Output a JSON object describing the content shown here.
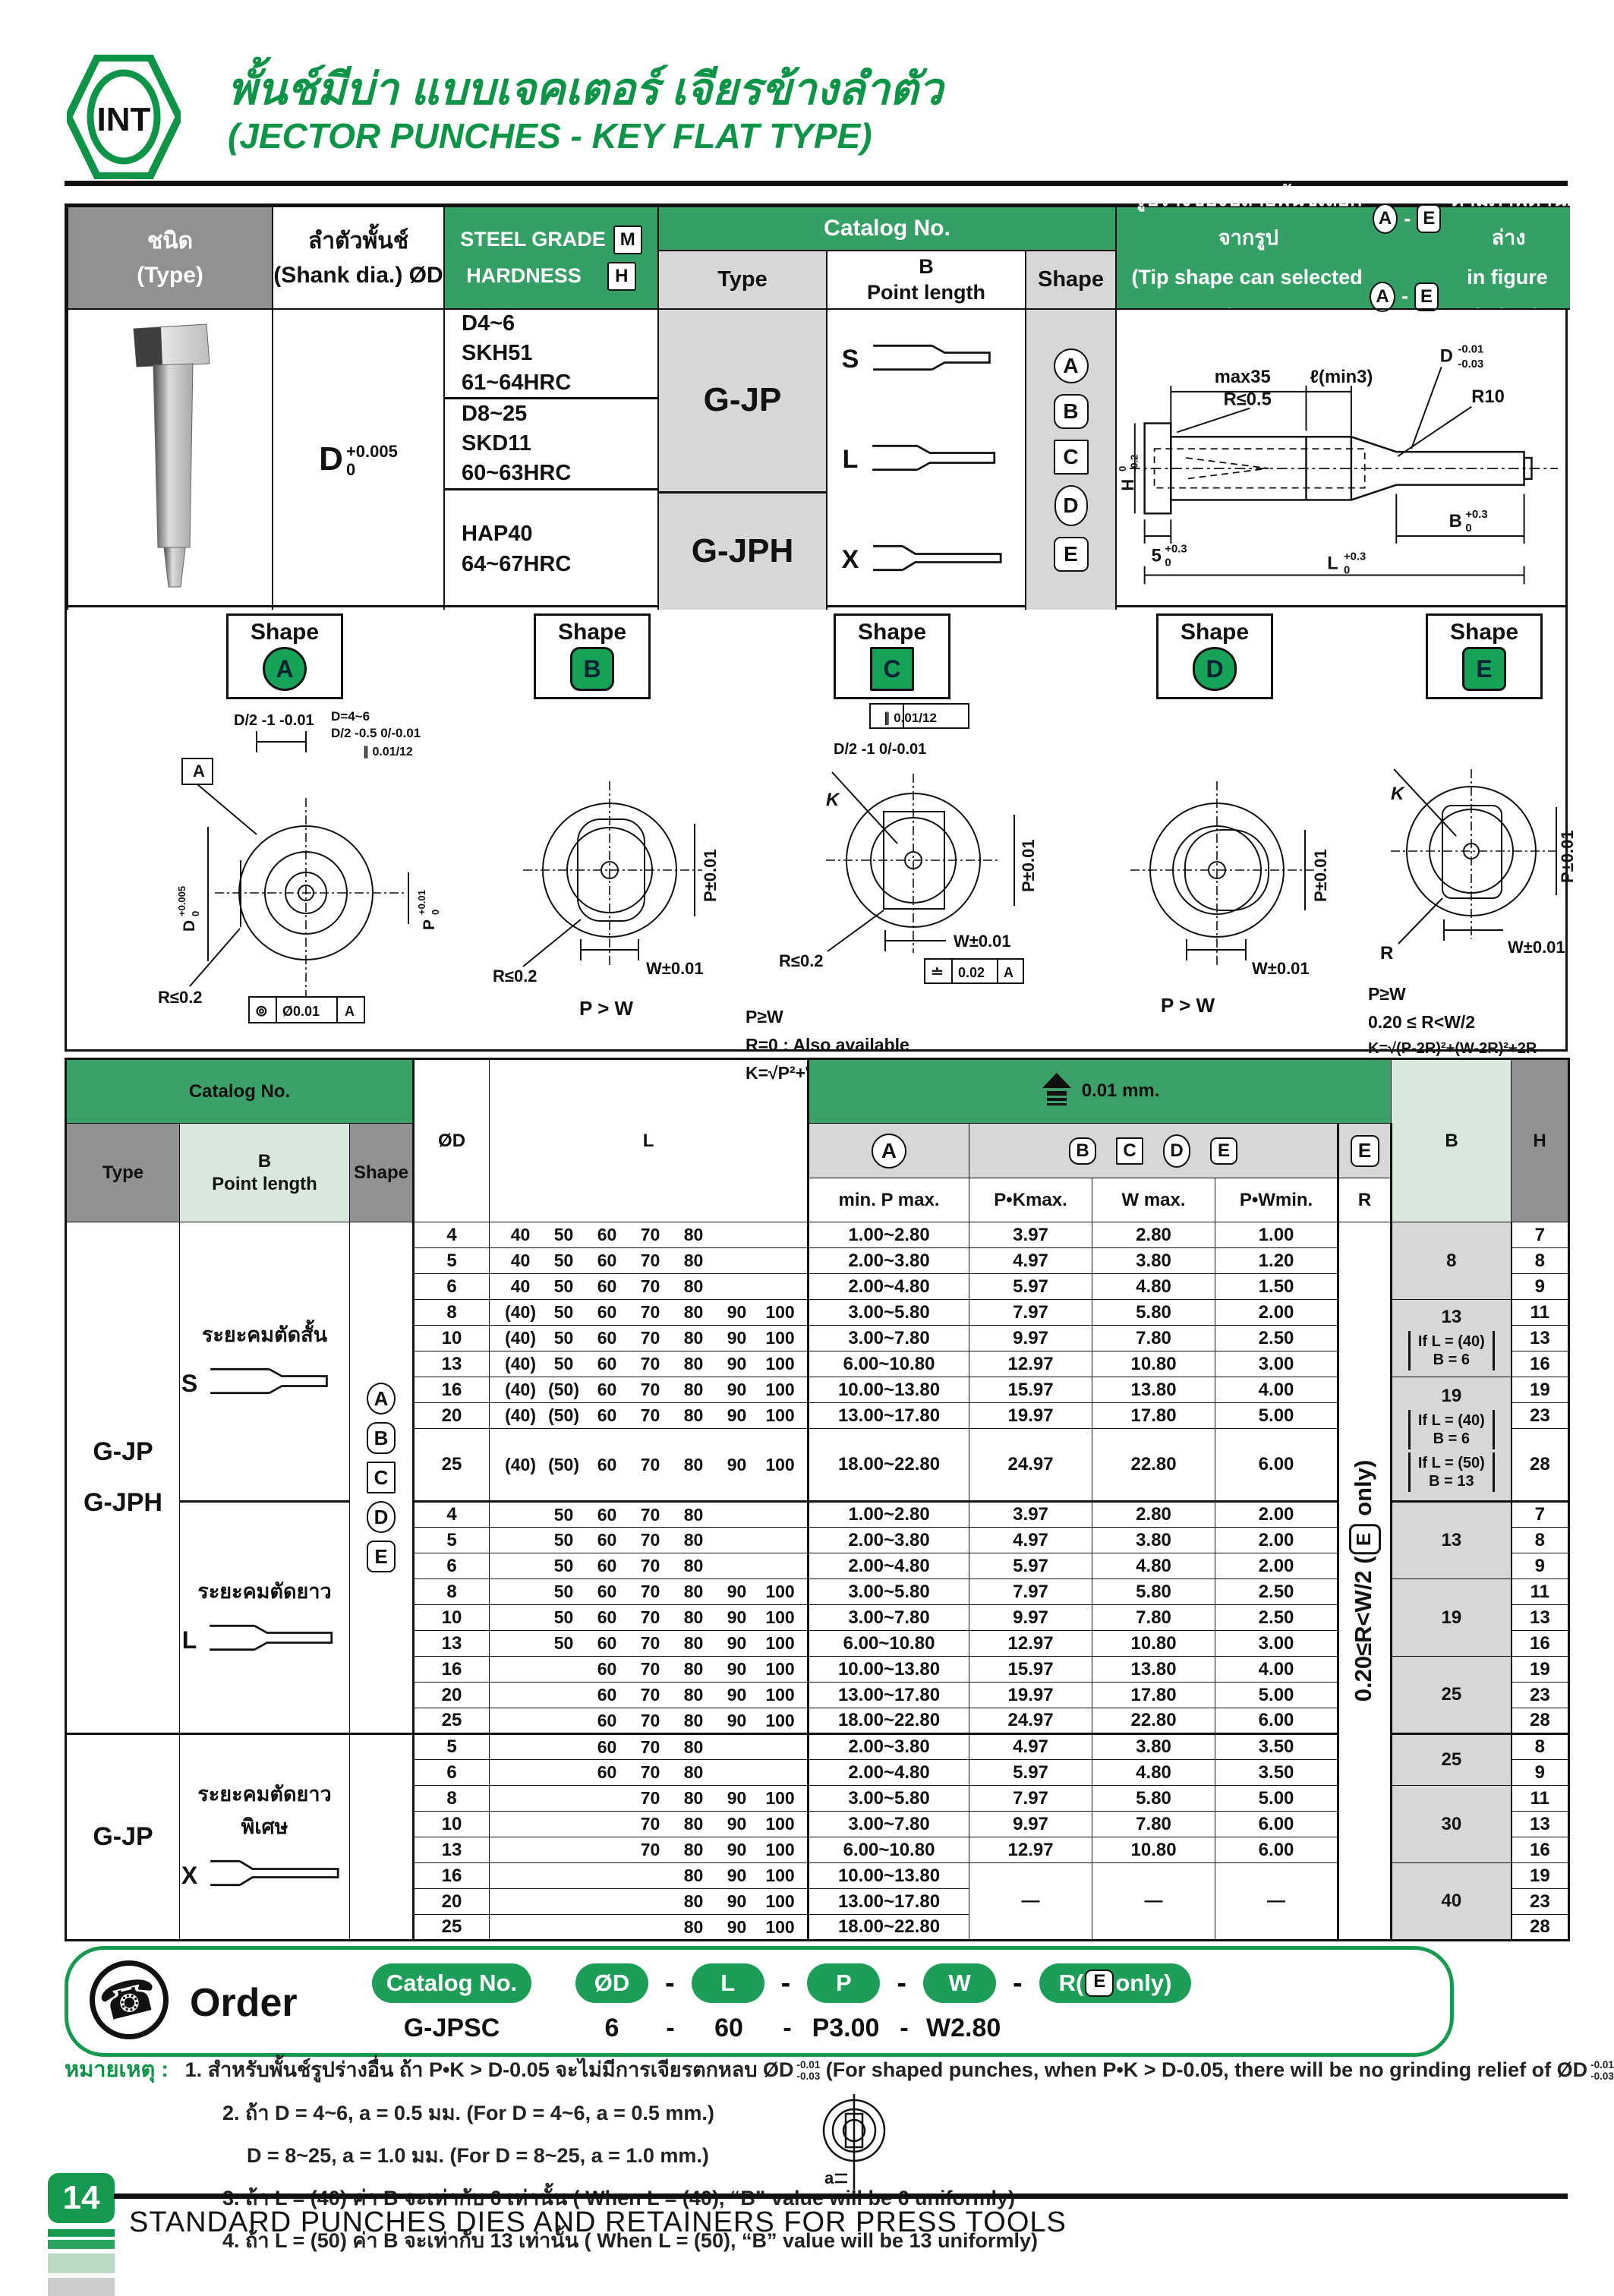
{
  "colors": {
    "brand_green": "#0d9447",
    "band_green": "#35a065",
    "light_green": "#d8e8dc",
    "badge_green": "#16a257",
    "gray": "#8f9192",
    "light_gray": "#d6d7d6"
  },
  "header": {
    "logo": "INT",
    "title_th": "พั้นช์มีบ่า แบบเจคเตอร์ เจียรข้างลำตัว",
    "title_en": "(JECTOR PUNCHES - KEY FLAT TYPE)"
  },
  "spec": {
    "type_th": "ชนิด",
    "type_en": "(Type)",
    "shank_th": "ลำตัวพั้นช์",
    "shank_en": "(Shank dia.) ØD",
    "steel_grade": "STEEL GRADE",
    "m": "M",
    "hardness": "HARDNESS",
    "h": "H",
    "catalog_no": "Catalog No.",
    "cat_type": "Type",
    "cat_b": "B",
    "cat_point": "Point length",
    "cat_shape": "Shape",
    "tip_th_1": "รูปร่างของปลายพั้นช์เลือกจากรูป",
    "tip_th_2": "ตามภาพด้านล่าง",
    "tip_en_1": "(Tip shape can selected from",
    "tip_en_2": "in figure below)",
    "tip_badge_a": "A",
    "tip_badge_e": "E",
    "tip_dash": "-",
    "shank_d": "D",
    "shank_tol_top": "+0.005",
    "shank_tol_bot": "0",
    "steels": [
      [
        "D4~6",
        "SKH51",
        "61~64HRC"
      ],
      [
        "D8~25",
        "SKD11",
        "60~63HRC"
      ],
      [
        "HAP40",
        "64~67HRC"
      ]
    ],
    "cat_types": [
      "G-JP",
      "G-JPH"
    ],
    "profile_letters": [
      "S",
      "L",
      "X"
    ],
    "shape_badges": [
      "A",
      "B",
      "C",
      "D",
      "E"
    ],
    "drawing": {
      "max35": "max35",
      "lmin": "ℓ(min3)",
      "d": "D",
      "d_top": "-0.01",
      "d_bot": "-0.03",
      "r05": "R≤0.5",
      "r10": "R10",
      "h": "H",
      "h_top": "0",
      "h_bot": "-0.2",
      "n5": "5",
      "n5_top": "+0.3",
      "n5_bot": "0",
      "b": "B",
      "b_top": "+0.3",
      "b_bot": "0",
      "l": "L",
      "l_top": "+0.3",
      "l_bot": "0"
    }
  },
  "shape_panels": [
    {
      "label": "Shape",
      "badge": "A",
      "ann": {
        "datum": "A",
        "top": "D/2 -1 -0.01",
        "par1": "D=4~6",
        "par2": "D/2 -0.5 0/-0.01",
        "frame": "∥ 0.01/12",
        "dleft": "D",
        "dleft_top": "+0.005",
        "dleft_bot": "0",
        "pright": "P",
        "pright_top": "+0.01",
        "pright_bot": "0",
        "r": "R≤0.2",
        "fcf_sym": "⊚",
        "fcf_val": "Ø0.01",
        "fcf_ref": "A"
      }
    },
    {
      "label": "Shape",
      "badge": "B",
      "ann": {
        "p": "P±0.01",
        "w": "W±0.01",
        "r": "R≤0.2",
        "rel": "P > W"
      }
    },
    {
      "label": "Shape",
      "badge": "C",
      "ann": {
        "frame": "∥ 0.01/12",
        "top": "D/2 -1 0/-0.01",
        "k": "K",
        "p": "P±0.01",
        "w": "W±0.01",
        "r": "R≤0.2",
        "fcf_sym": "≐",
        "fcf_val": "0.02",
        "fcf_ref": "A",
        "n1": "P≥W",
        "n2": "R=0 : Also available",
        "n3": "K=√P²+W²"
      }
    },
    {
      "label": "Shape",
      "badge": "D",
      "ann": {
        "p": "P±0.01",
        "w": "W±0.01",
        "rel": "P > W"
      }
    },
    {
      "label": "Shape",
      "badge": "E",
      "ann": {
        "k": "K",
        "r": "R",
        "p": "P±0.01",
        "w": "W±0.01",
        "n1": "P≥W",
        "n2": "0.20 ≤ R<W/2",
        "n3": "K=√(P-2R)²+(W-2R)²+2R"
      }
    }
  ],
  "main_table": {
    "catalog_no": "Catalog No.",
    "type": "Type",
    "b": "B",
    "point_length": "Point length",
    "shape": "Shape",
    "od": "ØD",
    "l": "L",
    "precision": "0.01 mm.",
    "badge_a": "A",
    "badges_bcde": [
      "B",
      "C",
      "D",
      "E"
    ],
    "badge_e": "E",
    "min_p_max": "min. P max.",
    "pk_max": "P•Kmax.",
    "w_max": "W max.",
    "pw_min": "P•Wmin.",
    "r": "R",
    "b_col": "B",
    "h_col": "H",
    "dash": "—",
    "r_note_pre": "0.20≤R<W/2 (",
    "r_note_badge": "E",
    "r_note_post": " only)",
    "type_groups": [
      {
        "span": 18,
        "lines": [
          "G-JP",
          "G-JPH"
        ]
      },
      {
        "span": 8,
        "lines": [
          "G-JP"
        ]
      }
    ],
    "bpoint_groups": [
      {
        "span": 9,
        "th": "ระยะคมตัดสั้น",
        "letter": "S"
      },
      {
        "span": 9,
        "th": "ระยะคมตัดยาว",
        "letter": "L"
      },
      {
        "span": 8,
        "th": "ระยะคมตัดยาวพิเศษ",
        "letter": "X"
      }
    ],
    "shape_groups": [
      {
        "span": 18,
        "badges": [
          "A",
          "B",
          "C",
          "D",
          "E"
        ]
      },
      {
        "span": 8,
        "badges": []
      }
    ],
    "b_groups": [
      {
        "span": 3,
        "num": "8",
        "conds": []
      },
      {
        "span": 3,
        "num": "13",
        "conds": [
          [
            "If L = (40)",
            "B = 6"
          ]
        ]
      },
      {
        "span": 3,
        "num": "19",
        "conds": [
          [
            "If L = (40)",
            "B = 6"
          ],
          [
            "If L = (50)",
            "B = 13"
          ]
        ]
      },
      {
        "span": 3,
        "num": "13",
        "conds": []
      },
      {
        "span": 3,
        "num": "19",
        "conds": []
      },
      {
        "span": 3,
        "num": "25",
        "conds": []
      },
      {
        "span": 2,
        "num": "25",
        "conds": []
      },
      {
        "span": 3,
        "num": "30",
        "conds": []
      },
      {
        "span": 3,
        "num": "40",
        "conds": []
      }
    ],
    "sections": [
      {
        "rows": [
          {
            "od": "4",
            "l": [
              "40",
              "50",
              "60",
              "70",
              "80",
              "",
              ""
            ],
            "a": "1.00~2.80",
            "pk": "3.97",
            "w": "2.80",
            "pw": "1.00",
            "h": "7"
          },
          {
            "od": "5",
            "l": [
              "40",
              "50",
              "60",
              "70",
              "80",
              "",
              ""
            ],
            "a": "2.00~3.80",
            "pk": "4.97",
            "w": "3.80",
            "pw": "1.20",
            "h": "8"
          },
          {
            "od": "6",
            "l": [
              "40",
              "50",
              "60",
              "70",
              "80",
              "",
              ""
            ],
            "a": "2.00~4.80",
            "pk": "5.97",
            "w": "4.80",
            "pw": "1.50",
            "h": "9"
          },
          {
            "od": "8",
            "l": [
              "(40)",
              "50",
              "60",
              "70",
              "80",
              "90",
              "100"
            ],
            "a": "3.00~5.80",
            "pk": "7.97",
            "w": "5.80",
            "pw": "2.00",
            "h": "11"
          },
          {
            "od": "10",
            "l": [
              "(40)",
              "50",
              "60",
              "70",
              "80",
              "90",
              "100"
            ],
            "a": "3.00~7.80",
            "pk": "9.97",
            "w": "7.80",
            "pw": "2.50",
            "h": "13"
          },
          {
            "od": "13",
            "l": [
              "(40)",
              "50",
              "60",
              "70",
              "80",
              "90",
              "100"
            ],
            "a": "6.00~10.80",
            "pk": "12.97",
            "w": "10.80",
            "pw": "3.00",
            "h": "16"
          },
          {
            "od": "16",
            "l": [
              "(40)",
              "(50)",
              "60",
              "70",
              "80",
              "90",
              "100"
            ],
            "a": "10.00~13.80",
            "pk": "15.97",
            "w": "13.80",
            "pw": "4.00",
            "h": "19"
          },
          {
            "od": "20",
            "l": [
              "(40)",
              "(50)",
              "60",
              "70",
              "80",
              "90",
              "100"
            ],
            "a": "13.00~17.80",
            "pk": "19.97",
            "w": "17.80",
            "pw": "5.00",
            "h": "23"
          },
          {
            "od": "25",
            "l": [
              "(40)",
              "(50)",
              "60",
              "70",
              "80",
              "90",
              "100"
            ],
            "a": "18.00~22.80",
            "pk": "24.97",
            "w": "22.80",
            "pw": "6.00",
            "h": "28",
            "tall": true
          }
        ]
      },
      {
        "rows": [
          {
            "od": "4",
            "l": [
              "",
              "50",
              "60",
              "70",
              "80",
              "",
              ""
            ],
            "a": "1.00~2.80",
            "pk": "3.97",
            "w": "2.80",
            "pw": "2.00",
            "h": "7"
          },
          {
            "od": "5",
            "l": [
              "",
              "50",
              "60",
              "70",
              "80",
              "",
              ""
            ],
            "a": "2.00~3.80",
            "pk": "4.97",
            "w": "3.80",
            "pw": "2.00",
            "h": "8"
          },
          {
            "od": "6",
            "l": [
              "",
              "50",
              "60",
              "70",
              "80",
              "",
              ""
            ],
            "a": "2.00~4.80",
            "pk": "5.97",
            "w": "4.80",
            "pw": "2.00",
            "h": "9"
          },
          {
            "od": "8",
            "l": [
              "",
              "50",
              "60",
              "70",
              "80",
              "90",
              "100"
            ],
            "a": "3.00~5.80",
            "pk": "7.97",
            "w": "5.80",
            "pw": "2.50",
            "h": "11"
          },
          {
            "od": "10",
            "l": [
              "",
              "50",
              "60",
              "70",
              "80",
              "90",
              "100"
            ],
            "a": "3.00~7.80",
            "pk": "9.97",
            "w": "7.80",
            "pw": "2.50",
            "h": "13"
          },
          {
            "od": "13",
            "l": [
              "",
              "50",
              "60",
              "70",
              "80",
              "90",
              "100"
            ],
            "a": "6.00~10.80",
            "pk": "12.97",
            "w": "10.80",
            "pw": "3.00",
            "h": "16"
          },
          {
            "od": "16",
            "l": [
              "",
              "",
              "60",
              "70",
              "80",
              "90",
              "100"
            ],
            "a": "10.00~13.80",
            "pk": "15.97",
            "w": "13.80",
            "pw": "4.00",
            "h": "19"
          },
          {
            "od": "20",
            "l": [
              "",
              "",
              "60",
              "70",
              "80",
              "90",
              "100"
            ],
            "a": "13.00~17.80",
            "pk": "19.97",
            "w": "17.80",
            "pw": "5.00",
            "h": "23"
          },
          {
            "od": "25",
            "l": [
              "",
              "",
              "60",
              "70",
              "80",
              "90",
              "100"
            ],
            "a": "18.00~22.80",
            "pk": "24.97",
            "w": "22.80",
            "pw": "6.00",
            "h": "28"
          }
        ]
      },
      {
        "rows": [
          {
            "od": "5",
            "l": [
              "",
              "",
              "60",
              "70",
              "80",
              "",
              ""
            ],
            "a": "2.00~3.80",
            "pk": "4.97",
            "w": "3.80",
            "pw": "3.50",
            "h": "8"
          },
          {
            "od": "6",
            "l": [
              "",
              "",
              "60",
              "70",
              "80",
              "",
              ""
            ],
            "a": "2.00~4.80",
            "pk": "5.97",
            "w": "4.80",
            "pw": "3.50",
            "h": "9"
          },
          {
            "od": "8",
            "l": [
              "",
              "",
              "",
              "70",
              "80",
              "90",
              "100"
            ],
            "a": "3.00~5.80",
            "pk": "7.97",
            "w": "5.80",
            "pw": "5.00",
            "h": "11"
          },
          {
            "od": "10",
            "l": [
              "",
              "",
              "",
              "70",
              "80",
              "90",
              "100"
            ],
            "a": "3.00~7.80",
            "pk": "9.97",
            "w": "7.80",
            "pw": "6.00",
            "h": "13"
          },
          {
            "od": "13",
            "l": [
              "",
              "",
              "",
              "70",
              "80",
              "90",
              "100"
            ],
            "a": "6.00~10.80",
            "pk": "12.97",
            "w": "10.80",
            "pw": "6.00",
            "h": "16"
          },
          {
            "od": "16",
            "l": [
              "",
              "",
              "",
              "",
              "80",
              "90",
              "100"
            ],
            "a": "10.00~13.80",
            "dash": true,
            "h": "19"
          },
          {
            "od": "20",
            "l": [
              "",
              "",
              "",
              "",
              "80",
              "90",
              "100"
            ],
            "a": "13.00~17.80",
            "h": "23"
          },
          {
            "od": "25",
            "l": [
              "",
              "",
              "",
              "",
              "80",
              "90",
              "100"
            ],
            "a": "18.00~22.80",
            "h": "28"
          }
        ]
      }
    ]
  },
  "order": {
    "label": "Order",
    "catalog_pill": "Catalog No.",
    "pills": [
      "ØD",
      "L",
      "P",
      "W"
    ],
    "pill_r_pre": "R(",
    "pill_r_badge": "E",
    "pill_r_post": "only)",
    "dash": "-",
    "ex_cat": "G-JPSC",
    "ex_d": "6",
    "ex_l": "60",
    "ex_p": "P3.00",
    "ex_w": "W2.80"
  },
  "notes": {
    "heading": "หมายเหตุ :",
    "n1_th": "1. สำหรับพั้นช์รูปร่างอื่น ถ้า P•K > D-0.05 จะไม่มีการเจียรตกหลบ ØD",
    "n1_tol_top": "-0.01",
    "n1_tol_bot": "-0.03",
    "n1_en": "(For shaped punches, when P•K > D-0.05, there will be no grinding relief of ØD",
    "n1_close": ")",
    "n2a": "2. ถ้า D = 4~6, a = 0.5 มม. (For D = 4~6, a = 0.5 mm.)",
    "n2b": "D = 8~25, a = 1.0 มม. (For D = 8~25, a = 1.0 mm.)",
    "n2_a_label": "a",
    "n3": "3. ถ้า L = (40) ค่า B จะเท่ากับ 6 เท่านั้น ( When L = (40), “B” value will be 6 uniformly)",
    "n4": "4. ถ้า L = (50) ค่า B จะเท่ากับ 13 เท่านั้น ( When L = (50), “B” value will be 13 uniformly)"
  },
  "footer": {
    "page": "14",
    "text": "STANDARD PUNCHES DIES AND RETAINERS FOR PRESS TOOLS"
  }
}
